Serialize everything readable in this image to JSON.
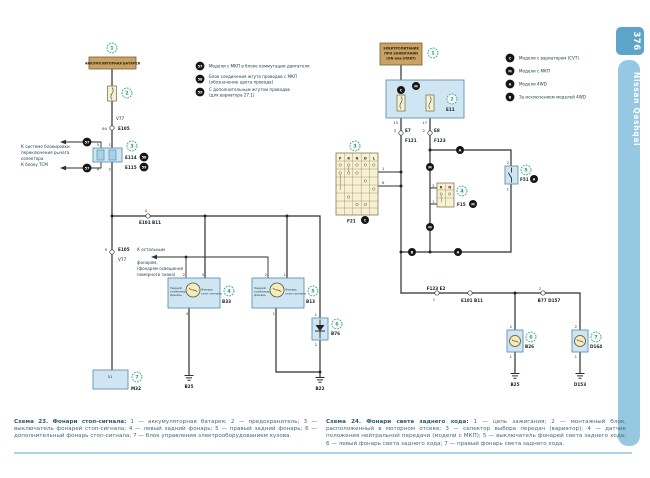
{
  "page": {
    "number": "376",
    "book_title": "Nissan Qashqai"
  },
  "colors": {
    "sidebar": "#96c8e2",
    "tab": "#5da4c8",
    "callout_green": "#3fa08e",
    "box_blue": "#cfe5f2",
    "box_tan": "#c9a266",
    "box_yellow": "#f7f1d2",
    "wire": "#2e2e2e"
  },
  "glyphs": {
    "n1": "1",
    "n2": "2",
    "n3": "3",
    "n4": "4",
    "n5": "5",
    "n6": "6",
    "n7": "7",
    "n9": "9",
    "n15": "15",
    "n17": "17",
    "n51": "51",
    "n57": "57",
    "n58": "58",
    "n59": "59",
    "n60": "60",
    "lC": "C",
    "lM": "M",
    "lA": "A",
    "lB": "B"
  },
  "s23": {
    "battery": "АККУМУЛЯТОРНАЯ БАТАРЕЯ",
    "v77": "V77",
    "e105": "E105",
    "e114": "E114",
    "e115": "E115",
    "e101_b11": "E101  B11",
    "m32": "M32",
    "b33": "B33",
    "b13": "B13",
    "b76": "B76",
    "b25": "B25",
    "b22": "B22",
    "side_note": [
      "К системе блокировки",
      "переключения рычага",
      "селектора",
      "К блоку ТСМ"
    ],
    "arrow_note": [
      "К остальным",
      "фонарям,",
      "(фонарям освещения",
      "номерного знака)"
    ],
    "lamp_left": [
      "Задний",
      "комбинир.",
      "фонарь"
    ],
    "lamp_right": [
      "Фонарь",
      "стоп-сигнала"
    ],
    "legend": [
      {
        "num": "57",
        "l1": "Модели с МКП в блоке коммутации двигателя",
        "l2": ""
      },
      {
        "num": "58",
        "l1": "Блок соединения жгута проводов с МКП",
        "l2": "(обозначение цвета провода)"
      },
      {
        "num": "59",
        "l1": "С дополнительным жгутом проводов",
        "l2": "(для вариатора 27.1)"
      }
    ]
  },
  "s24": {
    "power": [
      "ЭЛЕКТРОПИТАНИЕ",
      "ПРИ ЗАЖИГАНИИ",
      "(ON или START)"
    ],
    "e11": "E11",
    "e7": "E7",
    "f121": "F121",
    "e8": "E8",
    "f123": "F123",
    "f21": "F21",
    "f15": "F15",
    "f51": "F51",
    "cols": [
      "P",
      "R",
      "N",
      "D",
      "L"
    ],
    "cols2": [
      "R",
      "N"
    ],
    "f123_e2": "F123  E2",
    "e101_b11": "E101  B11",
    "b77_d157": "B77  D157",
    "b26": "B26",
    "b25": "B25",
    "d164": "D164",
    "d153": "D153",
    "legend": [
      {
        "letter": "C",
        "text": "Модели с вариатором (CVT)"
      },
      {
        "letter": "M",
        "text": "Модели с МКП"
      },
      {
        "letter": "A",
        "text": "Модели 4WD"
      },
      {
        "letter": "B",
        "text": "За исключением моделей 4WD"
      }
    ]
  },
  "captions": {
    "c23_lead": "Схема 23. Фонари стоп-сигнала:",
    "c23_body": " 1 — аккумуляторная батарея; 2 — предохранитель; 3 — выключатель фонарей стоп-сигнала; 4 — левый задний фонарь; 5 — правый задний фонарь; 6 — дополнительный фонарь стоп-сигнала; 7 — блок управления электрооборудованием кузова.",
    "c24_lead": "Схема 24. Фонари света заднего хода:",
    "c24_body": " 1 — цепь зажигания; 2 — монтажный блок, расположенный в моторном отсеке; 3 — селектор выбора передач (вариатор); 4 — датчик положения нейтральной передачи (модели с МКП); 5 — выключатель фонарей света заднего хода; 6 — левый фонарь света заднего хода; 7 — правый фонарь света заднего хода."
  }
}
